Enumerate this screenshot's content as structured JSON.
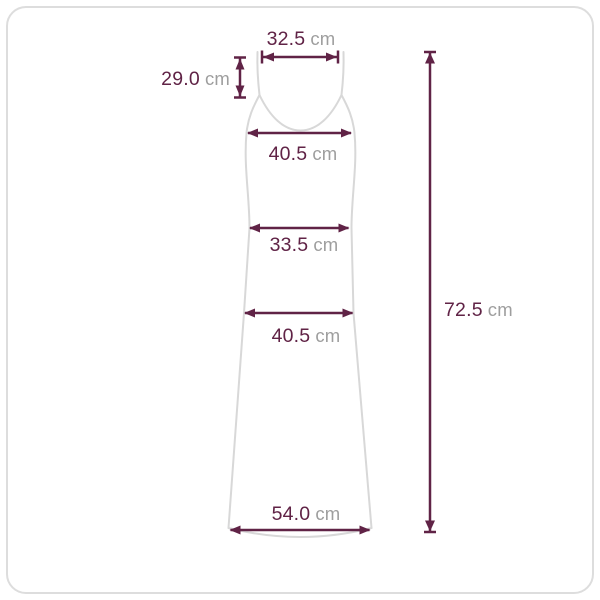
{
  "diagram": {
    "garment_icon": "sleeveless-slip-maxi-dress-outline",
    "colors": {
      "dimension": "#602346",
      "unit_text": "#9E9E9E",
      "garment_outline": "#D8D8D8",
      "frame_border": "#DDDDDD"
    },
    "measurements": {
      "top_width": {
        "value": "32.5",
        "unit": "cm"
      },
      "strap_drop": {
        "value": "29.0",
        "unit": "cm"
      },
      "bust_width": {
        "value": "40.5",
        "unit": "cm"
      },
      "waist_width": {
        "value": "33.5",
        "unit": "cm"
      },
      "hip_width": {
        "value": "40.5",
        "unit": "cm"
      },
      "hem_width": {
        "value": "54.0",
        "unit": "cm"
      },
      "total_length": {
        "value": "72.5",
        "unit": "cm"
      }
    }
  }
}
